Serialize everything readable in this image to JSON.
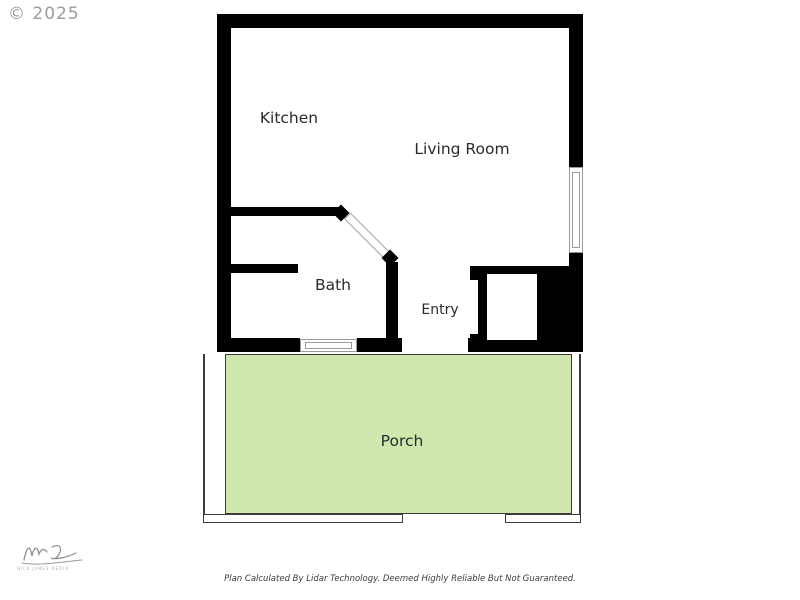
{
  "page": {
    "copyright": "© 2025",
    "disclaimer": "Plan Calculated By Lidar Technology. Deemed Highly Reliable But Not Guaranteed."
  },
  "watermark": {
    "signature_subtext": "NICK JAMES MEDIA"
  },
  "floorplan": {
    "rooms": [
      {
        "id": "kitchen",
        "label": "Kitchen"
      },
      {
        "id": "living-room",
        "label": "Living Room"
      },
      {
        "id": "bath",
        "label": "Bath"
      },
      {
        "id": "entry",
        "label": "Entry"
      },
      {
        "id": "porch",
        "label": "Porch"
      }
    ],
    "features": [
      "right-wall-window",
      "bath-window",
      "entry-door-opening",
      "angled-bath-doorway",
      "entry-closet",
      "porch-railing",
      "porch-stairs-opening"
    ],
    "colors": {
      "wall": "#000000",
      "porch_fill": "#cfe6ad",
      "porch_outline": "#3c3c3c",
      "window_frame": "#9a9a9a",
      "label_text": "#2b2b2b",
      "copyright_text": "#9b9b9b"
    }
  }
}
